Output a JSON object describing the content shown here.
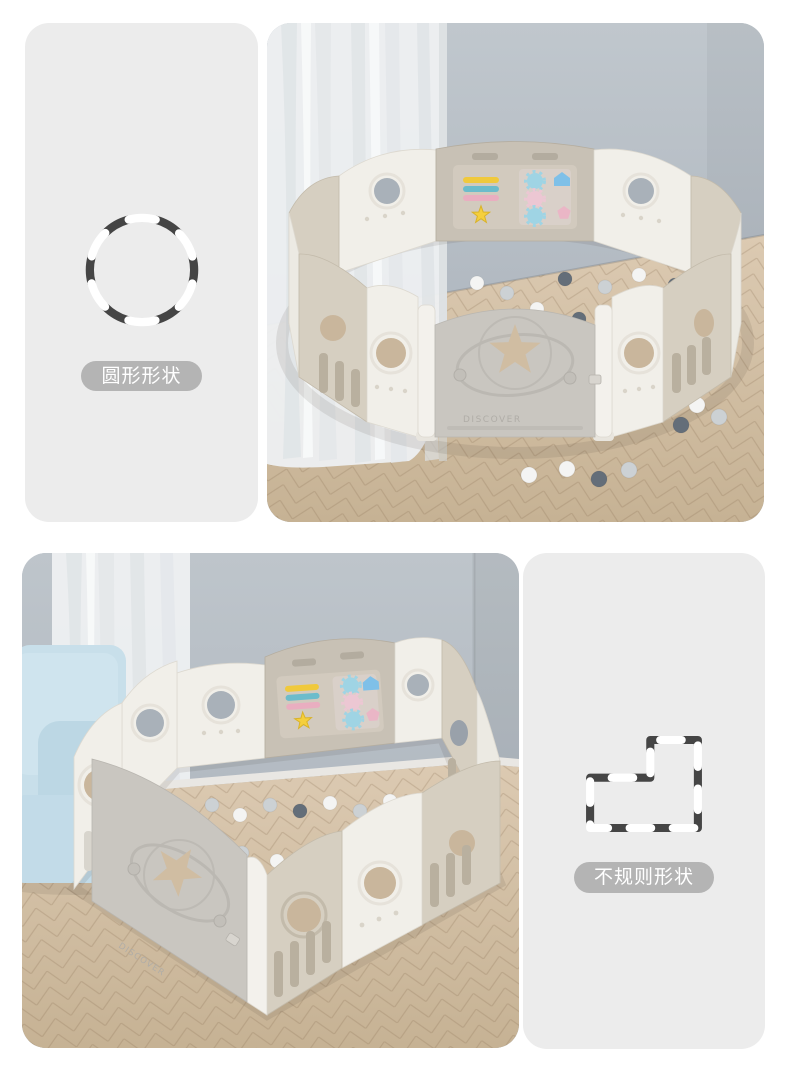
{
  "sections": {
    "round": {
      "label": "圆形形状",
      "icon": "dashed-circle-icon",
      "gate_text": "DISCOVER"
    },
    "irregular": {
      "label": "不规则形状",
      "icon": "dashed-irregular-shape-icon",
      "gate_text": "DISCOVER"
    }
  },
  "colors": {
    "page_bg": "#ffffff",
    "panel_bg": "#ececec",
    "badge_bg": "#b4b4b4",
    "badge_text": "#ffffff",
    "dash_dark": "#454545",
    "dash_white": "#ffffff",
    "wall_grey": "#b3bbc3",
    "floor_wood": "#d3c1a9",
    "curtain_white": "#eef0f2",
    "sofa_blue": "#c5dde9",
    "fence_white": "#f1efe9",
    "fence_beige": "#d6cfc1",
    "game_panel_tan": "#c8c1b5",
    "gate_grey": "#c9c6c0",
    "toy_yellow": "#f2cd3f",
    "toy_blue": "#9fd4e4",
    "toy_pink": "#ecc7d3",
    "ball_dark": "#646e79",
    "ball_grey": "#ccd1d4",
    "ball_white": "#f4f4f3"
  }
}
